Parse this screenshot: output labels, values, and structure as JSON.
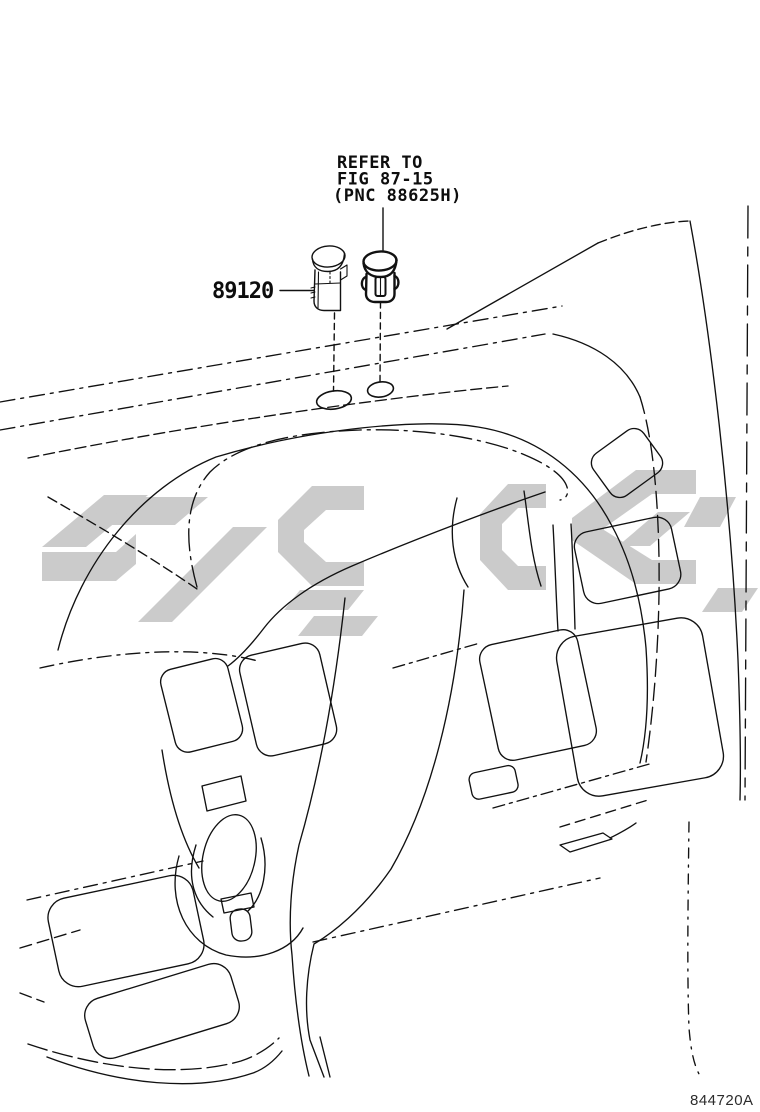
{
  "diagram": {
    "reference_note": {
      "line1": "REFER TO",
      "line2": "FIG 87-15",
      "line3": "(PNC 88625H)"
    },
    "part_number": "89120",
    "figure_code": "844720A",
    "parts": [
      {
        "name": "sensor-part",
        "label": "89120"
      },
      {
        "name": "clip-part",
        "label": "REFER TO FIG 87-15 (PNC 88625H)"
      }
    ],
    "colors": {
      "background": "#ffffff",
      "line": "#111111",
      "watermark": "#cbcbcb"
    }
  }
}
